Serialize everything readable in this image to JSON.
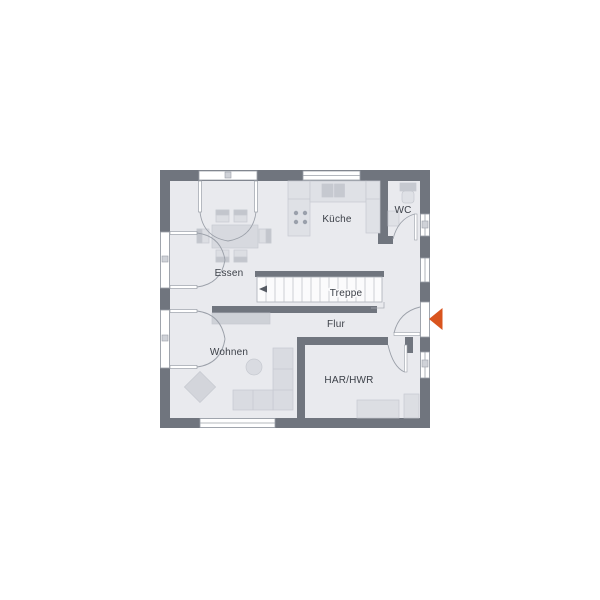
{
  "title": "Erdgeschoss Grundriss",
  "colors": {
    "background": "#ffffff",
    "wall": "#70757e",
    "floor": "#e9eaee",
    "floor_white": "#fbfbfc",
    "furniture": "#d9dbe1",
    "furniture_light": "#dfe1e6",
    "furniture_dark": "#c6c9d0",
    "outline": "#9ba0a9",
    "tread_line": "#b9bdc5",
    "stair_arrow": "#555a63",
    "accent_arrow": "#d9541e",
    "text": "#3c4048",
    "marker": "#cfd2d8"
  },
  "rooms": {
    "essen": {
      "label": "Essen"
    },
    "kueche": {
      "label": "Küche"
    },
    "wc": {
      "label": "WC"
    },
    "treppe": {
      "label": "Treppe"
    },
    "flur": {
      "label": "Flur"
    },
    "wohnen": {
      "label": "Wohnen"
    },
    "har_hwr": {
      "label": "HAR/HWR"
    }
  },
  "icons": {
    "entrance_arrow": "triangle-left",
    "stair_direction_arrow": "triangle-left"
  }
}
